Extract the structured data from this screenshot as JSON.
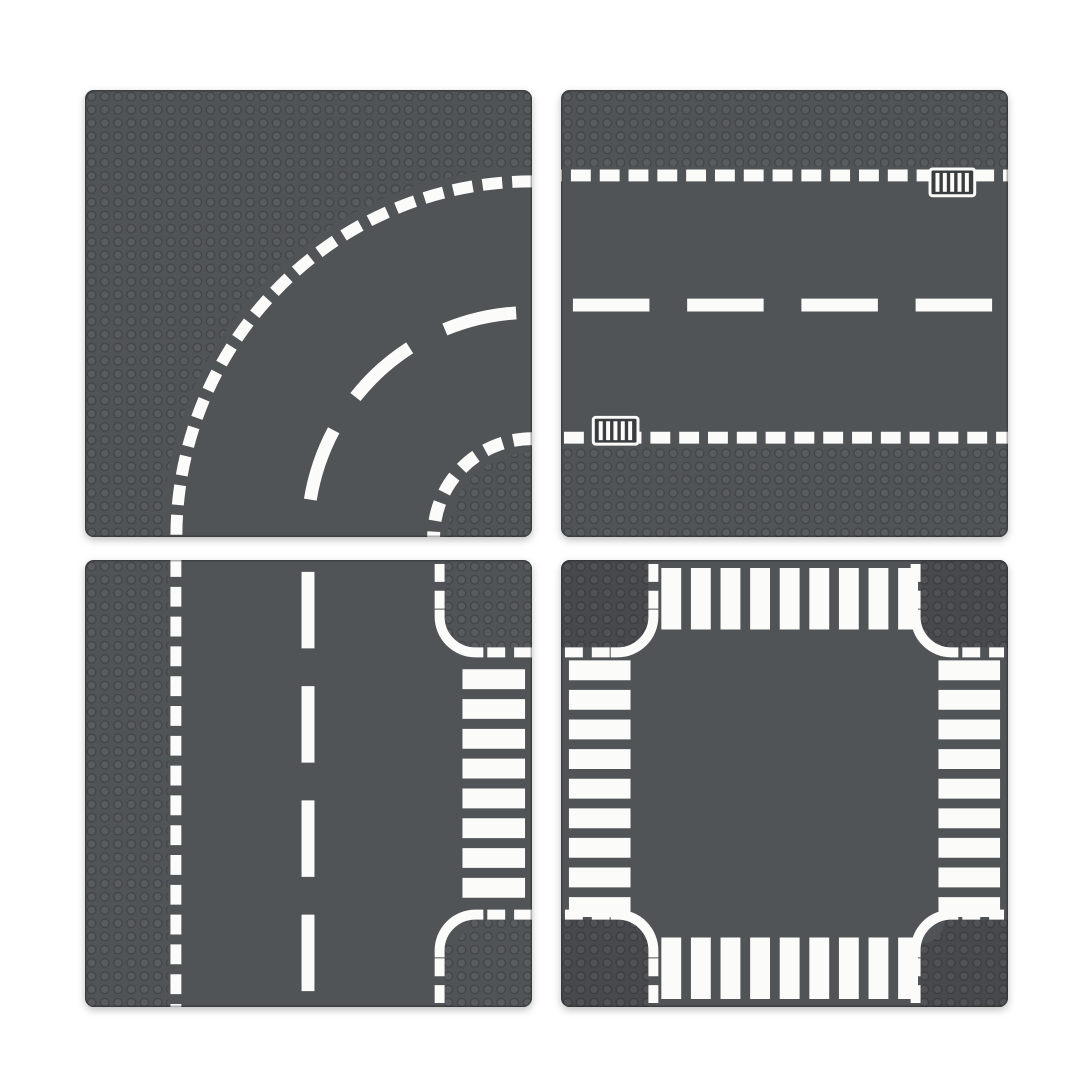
{
  "image": {
    "title": "Four toy road baseplates",
    "description": "Product image of four dark-gray studded road baseplates arranged in a 2x2 grid on a white background",
    "background": "#ffffff"
  },
  "colors": {
    "background": "#ffffff",
    "plate": "#515457",
    "stud_fill": "#595c5f",
    "stud_stroke": "#434649",
    "block": "#47494c",
    "block_stud_fill": "#505356",
    "block_stud_stroke": "#3b3e41",
    "marking": "#fbfbfa",
    "drain_fill": "#3a3d3f"
  },
  "plates": [
    {
      "id": "curved-road",
      "label": "Curved road baseplate with dashed curve markings",
      "grid_position": "top-left",
      "markings": {
        "outer_dashed_arc_radius": 358,
        "center_dashed_arc_radius": 224,
        "inner_dashed_arc_radius": 99,
        "corner_stud_quarter_radius": 85
      }
    },
    {
      "id": "straight-road",
      "label": "Straight road baseplate with two drain grates",
      "grid_position": "top-right",
      "markings": {
        "edge_dash_lines": 2,
        "center_long_dashes": 4,
        "drain_grates": 2
      }
    },
    {
      "id": "t-junction",
      "label": "T-junction road baseplate with zebra crosswalk",
      "grid_position": "bottom-left",
      "markings": {
        "edge_dash_lines": 1,
        "center_long_dashes": 4,
        "crosswalk_stripes": 8,
        "corner_stud_blocks": 2
      }
    },
    {
      "id": "crossroad",
      "label": "Crossroad intersection baseplate with four zebra crosswalks",
      "grid_position": "bottom-right",
      "markings": {
        "crosswalks": 4,
        "crosswalk_stripes_each": 9,
        "corner_stud_blocks": 4
      }
    }
  ]
}
